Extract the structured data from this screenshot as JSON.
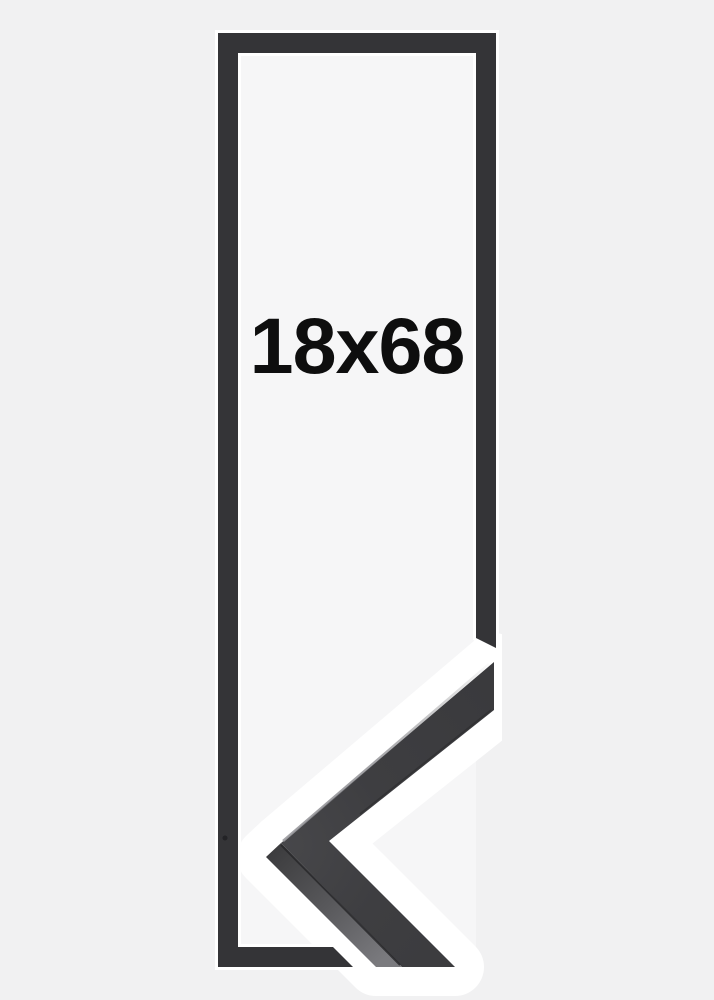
{
  "image": {
    "size_label": "18x68"
  },
  "colors": {
    "background": "#f1f1f2",
    "frame_opening": "#f6f6f7",
    "frame_outline": "#343437",
    "corner_face": "#3a3a3d",
    "corner_face_light": "#47474a",
    "corner_side_dark": "#3c3c3e",
    "corner_side_light": "#7a7a7e",
    "seam": "#28282a",
    "highlight": "#a0a0a4",
    "halo": "#ffffff",
    "label": "#0e0e0e"
  }
}
